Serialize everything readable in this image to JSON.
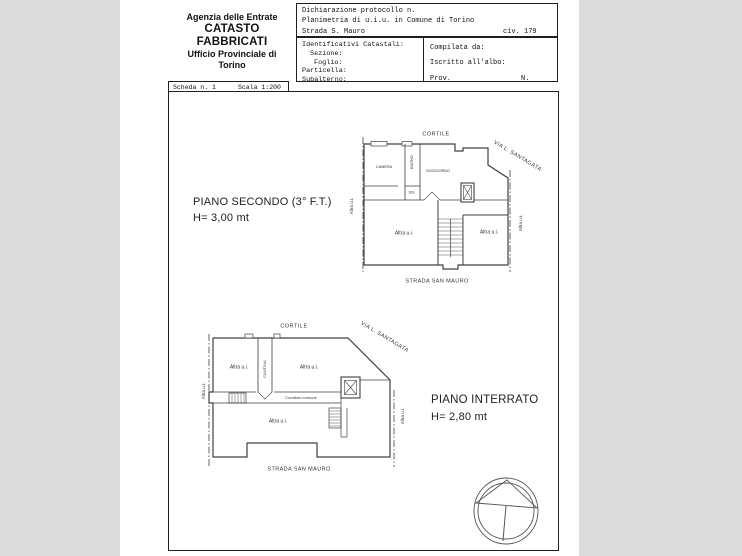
{
  "colors": {
    "background": "#dcdcdc",
    "paper": "#ffffff",
    "drawing_line": "#404040",
    "box_border": "#1f1f1f"
  },
  "header": {
    "agency": {
      "line1": "Agenzia delle Entrate",
      "line2": "CATASTO FABBRICATI",
      "line3": "Ufficio Provinciale di",
      "line4": "Torino"
    },
    "declaration": {
      "protocol": "Dichiarazione protocollo n.",
      "planimetria": "Planimetria di u.i.u. in Comune di Torino",
      "street": "Strada S. Mauro",
      "civ": "civ. 179"
    },
    "cadastral": {
      "title": "Identificativi Catastali:",
      "sezione": "Sezione:",
      "foglio": "Foglio:",
      "particella": "Particella:",
      "subalterno": "Subalterno:"
    },
    "compiler": {
      "compilata": "Compilata da:",
      "iscritto": "Iscritto all'albo:",
      "prov": "Prov.",
      "n": "N."
    },
    "sheet": {
      "scheda": "Scheda n. 1",
      "scala": "Scala 1:200"
    }
  },
  "plan_secondo": {
    "title": "PIANO SECONDO (3° F.T.)",
    "height_label": "H= 3,00 mt",
    "cortile": "CORTILE",
    "via": "VIA L. SANTAGATA",
    "camera": "CAMERA",
    "bagno": "BAGNO",
    "soggiorno": "SOGGIORNO",
    "dis": "DIS.",
    "altra_room_left": "Altra u.i.",
    "altra_room_right": "Altra u.i.",
    "altra_side_left": "Altra u.i.",
    "altra_side_right": "Altra u.i.",
    "strada": "STRADA SAN MAURO"
  },
  "plan_interrato": {
    "title": "PIANO INTERRATO",
    "height_label": "H= 2,80 mt",
    "cortile": "CORTILE",
    "via": "VIA L. SANTAGATA",
    "cantina": "CANTINA",
    "corridoio": "Corridoio comune",
    "altra_room_left": "Altra u.i.",
    "altra_room_right": "Altra u.i.",
    "altra_room_big": "Altra u.i.",
    "altra_side_left": "Altra u.i.",
    "altra_side_right": "Altra u.i.",
    "strada": "STRADA SAN MAURO"
  }
}
